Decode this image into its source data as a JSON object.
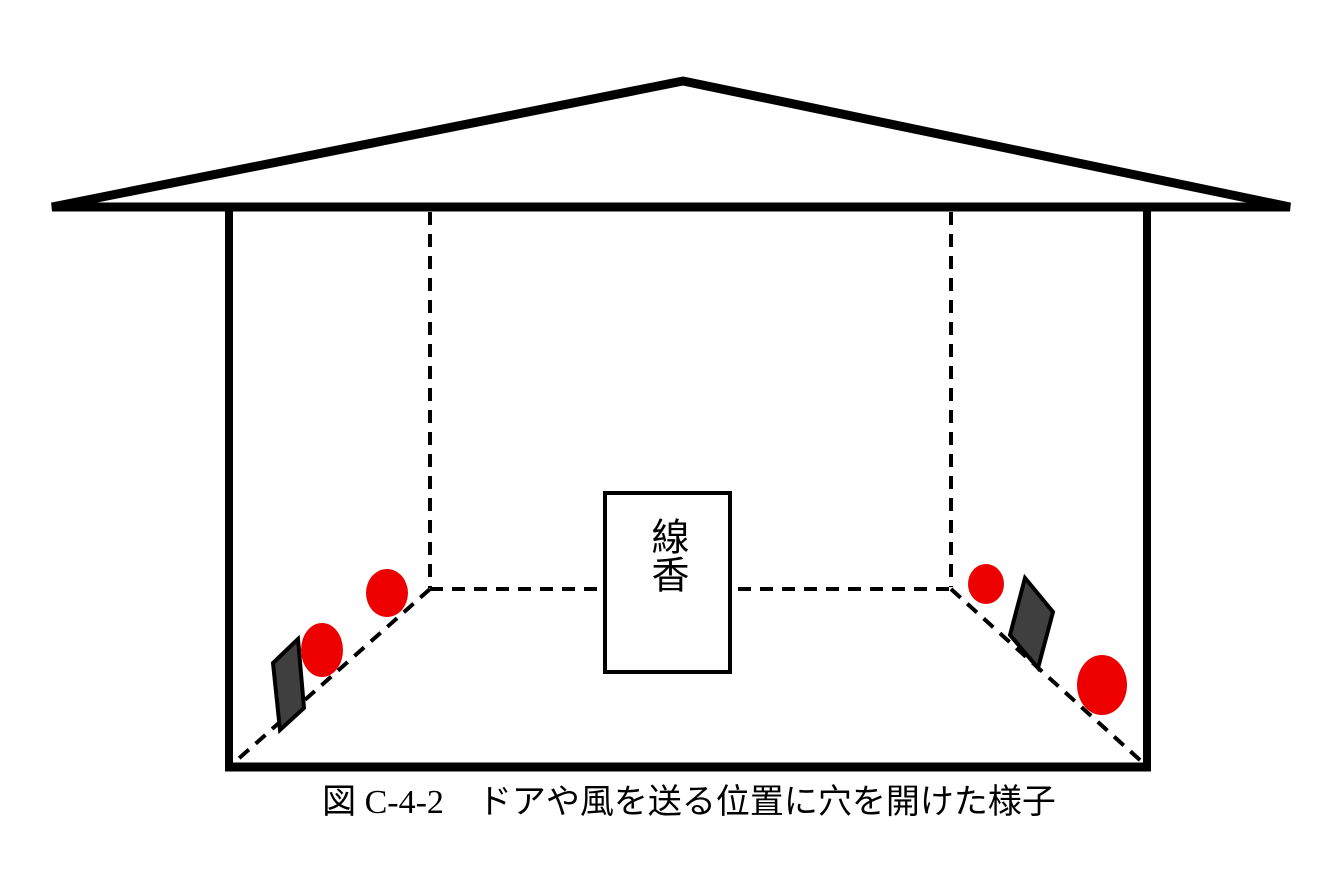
{
  "figure": {
    "caption": "図 C-4-2　ドアや風を送る位置に穴を開けた様子",
    "incense_box_label": "線香"
  },
  "colors": {
    "line": "#000000",
    "hole": "#ee0000",
    "door_panel": "#3f3f3f",
    "background": "#ffffff"
  }
}
